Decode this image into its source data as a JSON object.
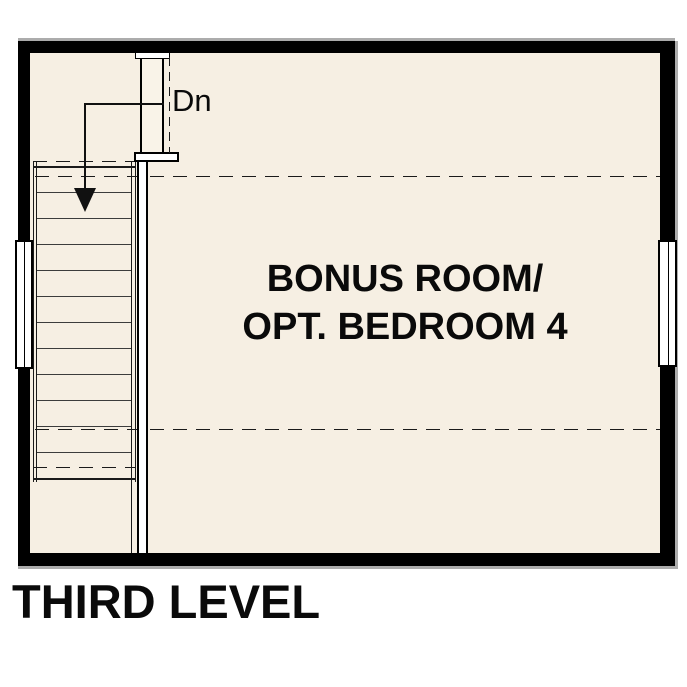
{
  "floor_plan": {
    "level_title": "THIRD LEVEL",
    "room": {
      "name_line1": "BONUS ROOM/",
      "name_line2": "OPT. BEDROOM 4"
    },
    "stairs": {
      "direction_label": "Dn",
      "visible_treads": 12
    },
    "colors": {
      "floor_fill": "#F6EFE3",
      "wall": "#000000",
      "shadow": "#ACACAC",
      "window_fill": "#FFFFFF",
      "line": "#1A1A1A"
    }
  }
}
